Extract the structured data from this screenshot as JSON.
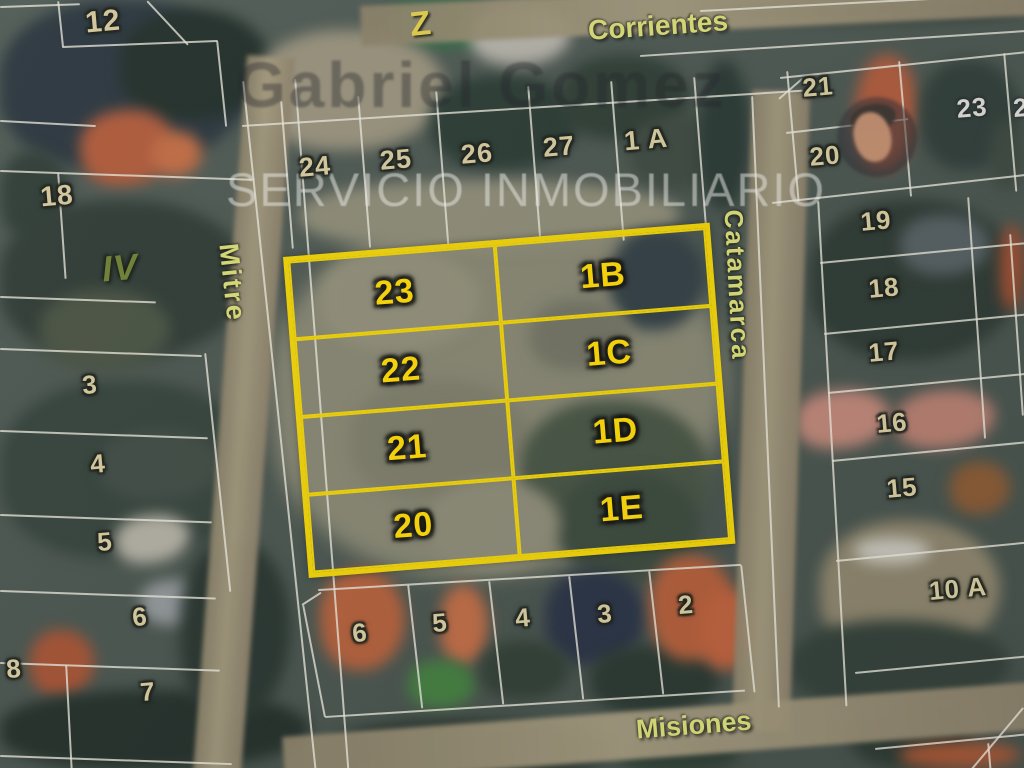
{
  "watermarks": {
    "agent_name": "Gabriel Gomez",
    "agency_tagline": "SERVICIO INMOBILIARIO",
    "partial_letter": "Z"
  },
  "streets": {
    "top": "Corrientes",
    "left": "Mitre",
    "right": "Catamarca",
    "bottom": "Misiones"
  },
  "highlighted_lots": {
    "outline_color": "#f2d400",
    "label_color": "#ffd900",
    "rows": [
      {
        "left": "23",
        "right": "1B"
      },
      {
        "left": "22",
        "right": "1C"
      },
      {
        "left": "21",
        "right": "1D"
      },
      {
        "left": "20",
        "right": "1E"
      }
    ]
  },
  "parcel_numbers": [
    {
      "label": "12",
      "x": 103,
      "y": 22,
      "size": 30
    },
    {
      "label": "24",
      "x": 315,
      "y": 167,
      "size": 27
    },
    {
      "label": "25",
      "x": 396,
      "y": 160,
      "size": 27
    },
    {
      "label": "26",
      "x": 477,
      "y": 154,
      "size": 27
    },
    {
      "label": "27",
      "x": 559,
      "y": 147,
      "size": 27
    },
    {
      "label": "1 A",
      "x": 646,
      "y": 140,
      "size": 27
    },
    {
      "label": "18",
      "x": 57,
      "y": 196,
      "size": 28
    },
    {
      "label": "IV",
      "x": 120,
      "y": 268,
      "size": 36,
      "variant": "olive"
    },
    {
      "label": "3",
      "x": 90,
      "y": 385,
      "size": 26
    },
    {
      "label": "4",
      "x": 98,
      "y": 464,
      "size": 26
    },
    {
      "label": "5",
      "x": 105,
      "y": 542,
      "size": 26
    },
    {
      "label": "6",
      "x": 140,
      "y": 617,
      "size": 26
    },
    {
      "label": "8",
      "x": 14,
      "y": 669,
      "size": 26
    },
    {
      "label": "7",
      "x": 148,
      "y": 692,
      "size": 26
    },
    {
      "label": "21",
      "x": 818,
      "y": 87,
      "size": 26
    },
    {
      "label": "23",
      "x": 972,
      "y": 108,
      "size": 26,
      "variant": "light"
    },
    {
      "label": "2",
      "x": 1021,
      "y": 108,
      "size": 26,
      "variant": "light"
    },
    {
      "label": "20",
      "x": 825,
      "y": 156,
      "size": 26
    },
    {
      "label": "19",
      "x": 876,
      "y": 221,
      "size": 26
    },
    {
      "label": "18",
      "x": 884,
      "y": 288,
      "size": 26
    },
    {
      "label": "17",
      "x": 884,
      "y": 352,
      "size": 26
    },
    {
      "label": "16",
      "x": 892,
      "y": 423,
      "size": 26
    },
    {
      "label": "15",
      "x": 902,
      "y": 488,
      "size": 26
    },
    {
      "label": "10 A",
      "x": 958,
      "y": 589,
      "size": 26
    },
    {
      "label": "6",
      "x": 360,
      "y": 633,
      "size": 26
    },
    {
      "label": "5",
      "x": 440,
      "y": 623,
      "size": 26
    },
    {
      "label": "4",
      "x": 523,
      "y": 618,
      "size": 26
    },
    {
      "label": "3",
      "x": 605,
      "y": 614,
      "size": 26
    },
    {
      "label": "2",
      "x": 686,
      "y": 605,
      "size": 26
    }
  ],
  "colors": {
    "parcel_number": "#d7cb9d",
    "street_label": "#dade74",
    "roman_numeral": "#6d8030"
  }
}
